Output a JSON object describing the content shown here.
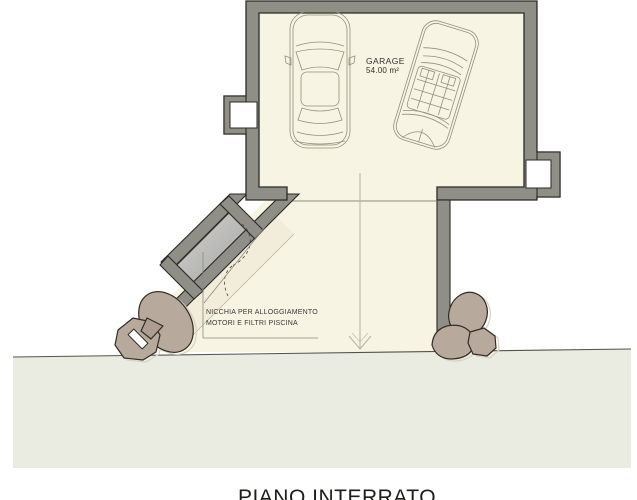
{
  "plan": {
    "title": "PIANO INTERRATO",
    "rooms": {
      "garage": {
        "label": "GARAGE",
        "area": "54.00 m²"
      }
    },
    "annotations": {
      "niche_note_line1": "NICCHIA PER ALLOGGIAMENTO",
      "niche_note_line2": "MOTORI E FILTRI PISCINA"
    },
    "icons": {
      "direction_arrow": "down-arrow",
      "door_swing": "dashed-arc"
    },
    "colors": {
      "wall_fill": "#8f8f88",
      "wall_outline": "#2b2a25",
      "floor_cream": "#f7f4e3",
      "niche_interior": "#bcbcba",
      "ground_fill": "#ebece1",
      "ground_line": "#55534a",
      "rock_fill": "#b7a99b",
      "rock_outline": "#312d26",
      "car_sketch": "#958f7d",
      "text": "#3a3933"
    }
  }
}
